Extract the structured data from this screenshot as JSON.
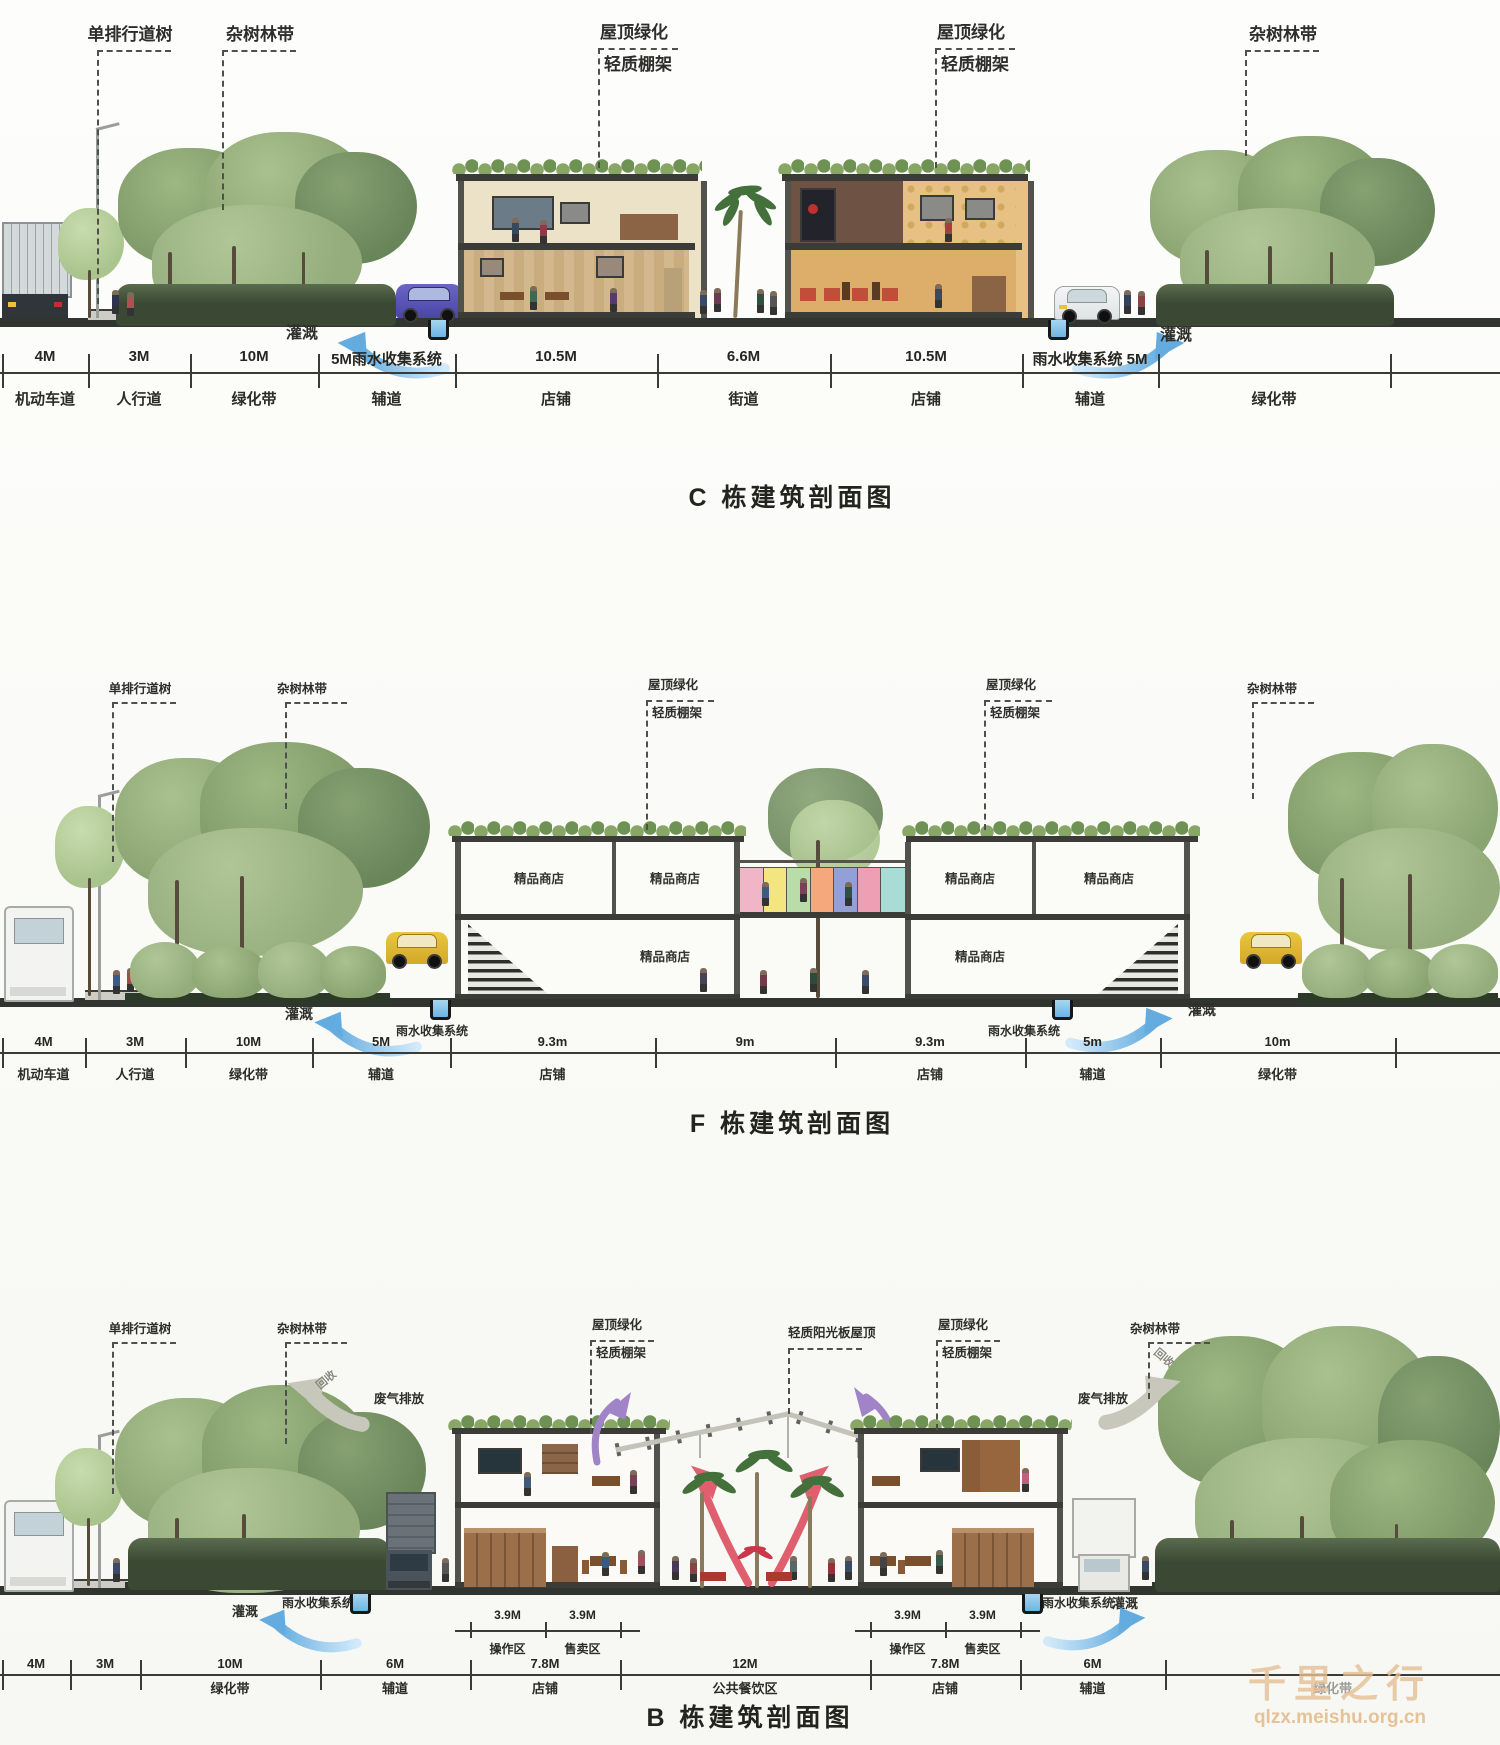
{
  "watermark": {
    "brand": "千里之行",
    "url": "qlzx.meishu.org.cn"
  },
  "colors": {
    "arrow_blue": "#74b7e8",
    "roof_green": "#7fa065",
    "tree_green": "#8aa471",
    "ground_dark": "#30362f",
    "watermark_tan": "#e5c094",
    "purple_arrow": "#a184c8",
    "red_arrow": "#df5f6e",
    "exhaust_gray": "#c7c7bb",
    "bridge_panels": [
      "#f0b6c8",
      "#f3e580",
      "#b9dca9",
      "#f4a87b",
      "#93a0d8",
      "#ef9fb4",
      "#a8dcd4"
    ]
  },
  "sections": [
    {
      "id": "C",
      "title": "C 栋建筑剖面图",
      "callouts": [
        "单排行道树",
        "杂树林带",
        "屋顶绿化",
        "轻质棚架",
        "屋顶绿化",
        "轻质棚架",
        "杂树林带"
      ],
      "water": {
        "irrigation_left": "灌溉",
        "irrigation_right": "灌溉"
      },
      "dims": [
        "4M",
        "3M",
        "10M",
        "5M雨水收集系统",
        "10.5M",
        "6.6M",
        "10.5M",
        "雨水收集系统 5M",
        ""
      ],
      "roads": [
        "机动车道",
        "人行道",
        "绿化带",
        "辅道",
        "店铺",
        "街道",
        "店铺",
        "辅道",
        "绿化带"
      ]
    },
    {
      "id": "F",
      "title": "F 栋建筑剖面图",
      "callouts": [
        "单排行道树",
        "杂树林带",
        "屋顶绿化",
        "轻质棚架",
        "屋顶绿化",
        "轻质棚架",
        "杂树林带"
      ],
      "water": {
        "irrigation_left": "灌溉",
        "irrigation_right": "灌溉",
        "rain_left": "雨水收集系统",
        "rain_right": "雨水收集系统"
      },
      "shop_label": "精品商店",
      "dims": [
        "4M",
        "3M",
        "10M",
        "5M",
        "9.3m",
        "9m",
        "9.3m",
        "5m",
        "10m"
      ],
      "roads": [
        "机动车道",
        "人行道",
        "绿化带",
        "辅道",
        "店铺",
        "",
        "店铺",
        "辅道",
        "绿化带"
      ]
    },
    {
      "id": "B",
      "title": "B 栋建筑剖面图",
      "callouts": [
        "单排行道树",
        "杂树林带",
        "屋顶绿化",
        "轻质棚架",
        "轻质阳光板屋顶",
        "屋顶绿化",
        "轻质棚架",
        "杂树林带"
      ],
      "water": {
        "irrigation_left": "灌溉",
        "irrigation_right": "灌溉",
        "rain_left": "雨水收集系统",
        "rain_right": "雨水收集系统"
      },
      "exhaust_left": "废气排放",
      "exhaust_right": "废气排放",
      "recycle_left": "回收",
      "recycle_right": "回收",
      "subdims_left": {
        "dims": [
          "3.9M",
          "3.9M"
        ],
        "zones": [
          "操作区",
          "售卖区"
        ]
      },
      "subdims_right": {
        "dims": [
          "3.9M",
          "3.9M"
        ],
        "zones": [
          "操作区",
          "售卖区"
        ]
      },
      "dims": [
        "4M",
        "3M",
        "10M",
        "6M",
        "7.8M",
        "12M",
        "7.8M",
        "6M",
        ""
      ],
      "roads": [
        "",
        "",
        "绿化带",
        "辅道",
        "店铺",
        "公共餐饮区",
        "店铺",
        "辅道",
        "绿化带"
      ]
    }
  ]
}
